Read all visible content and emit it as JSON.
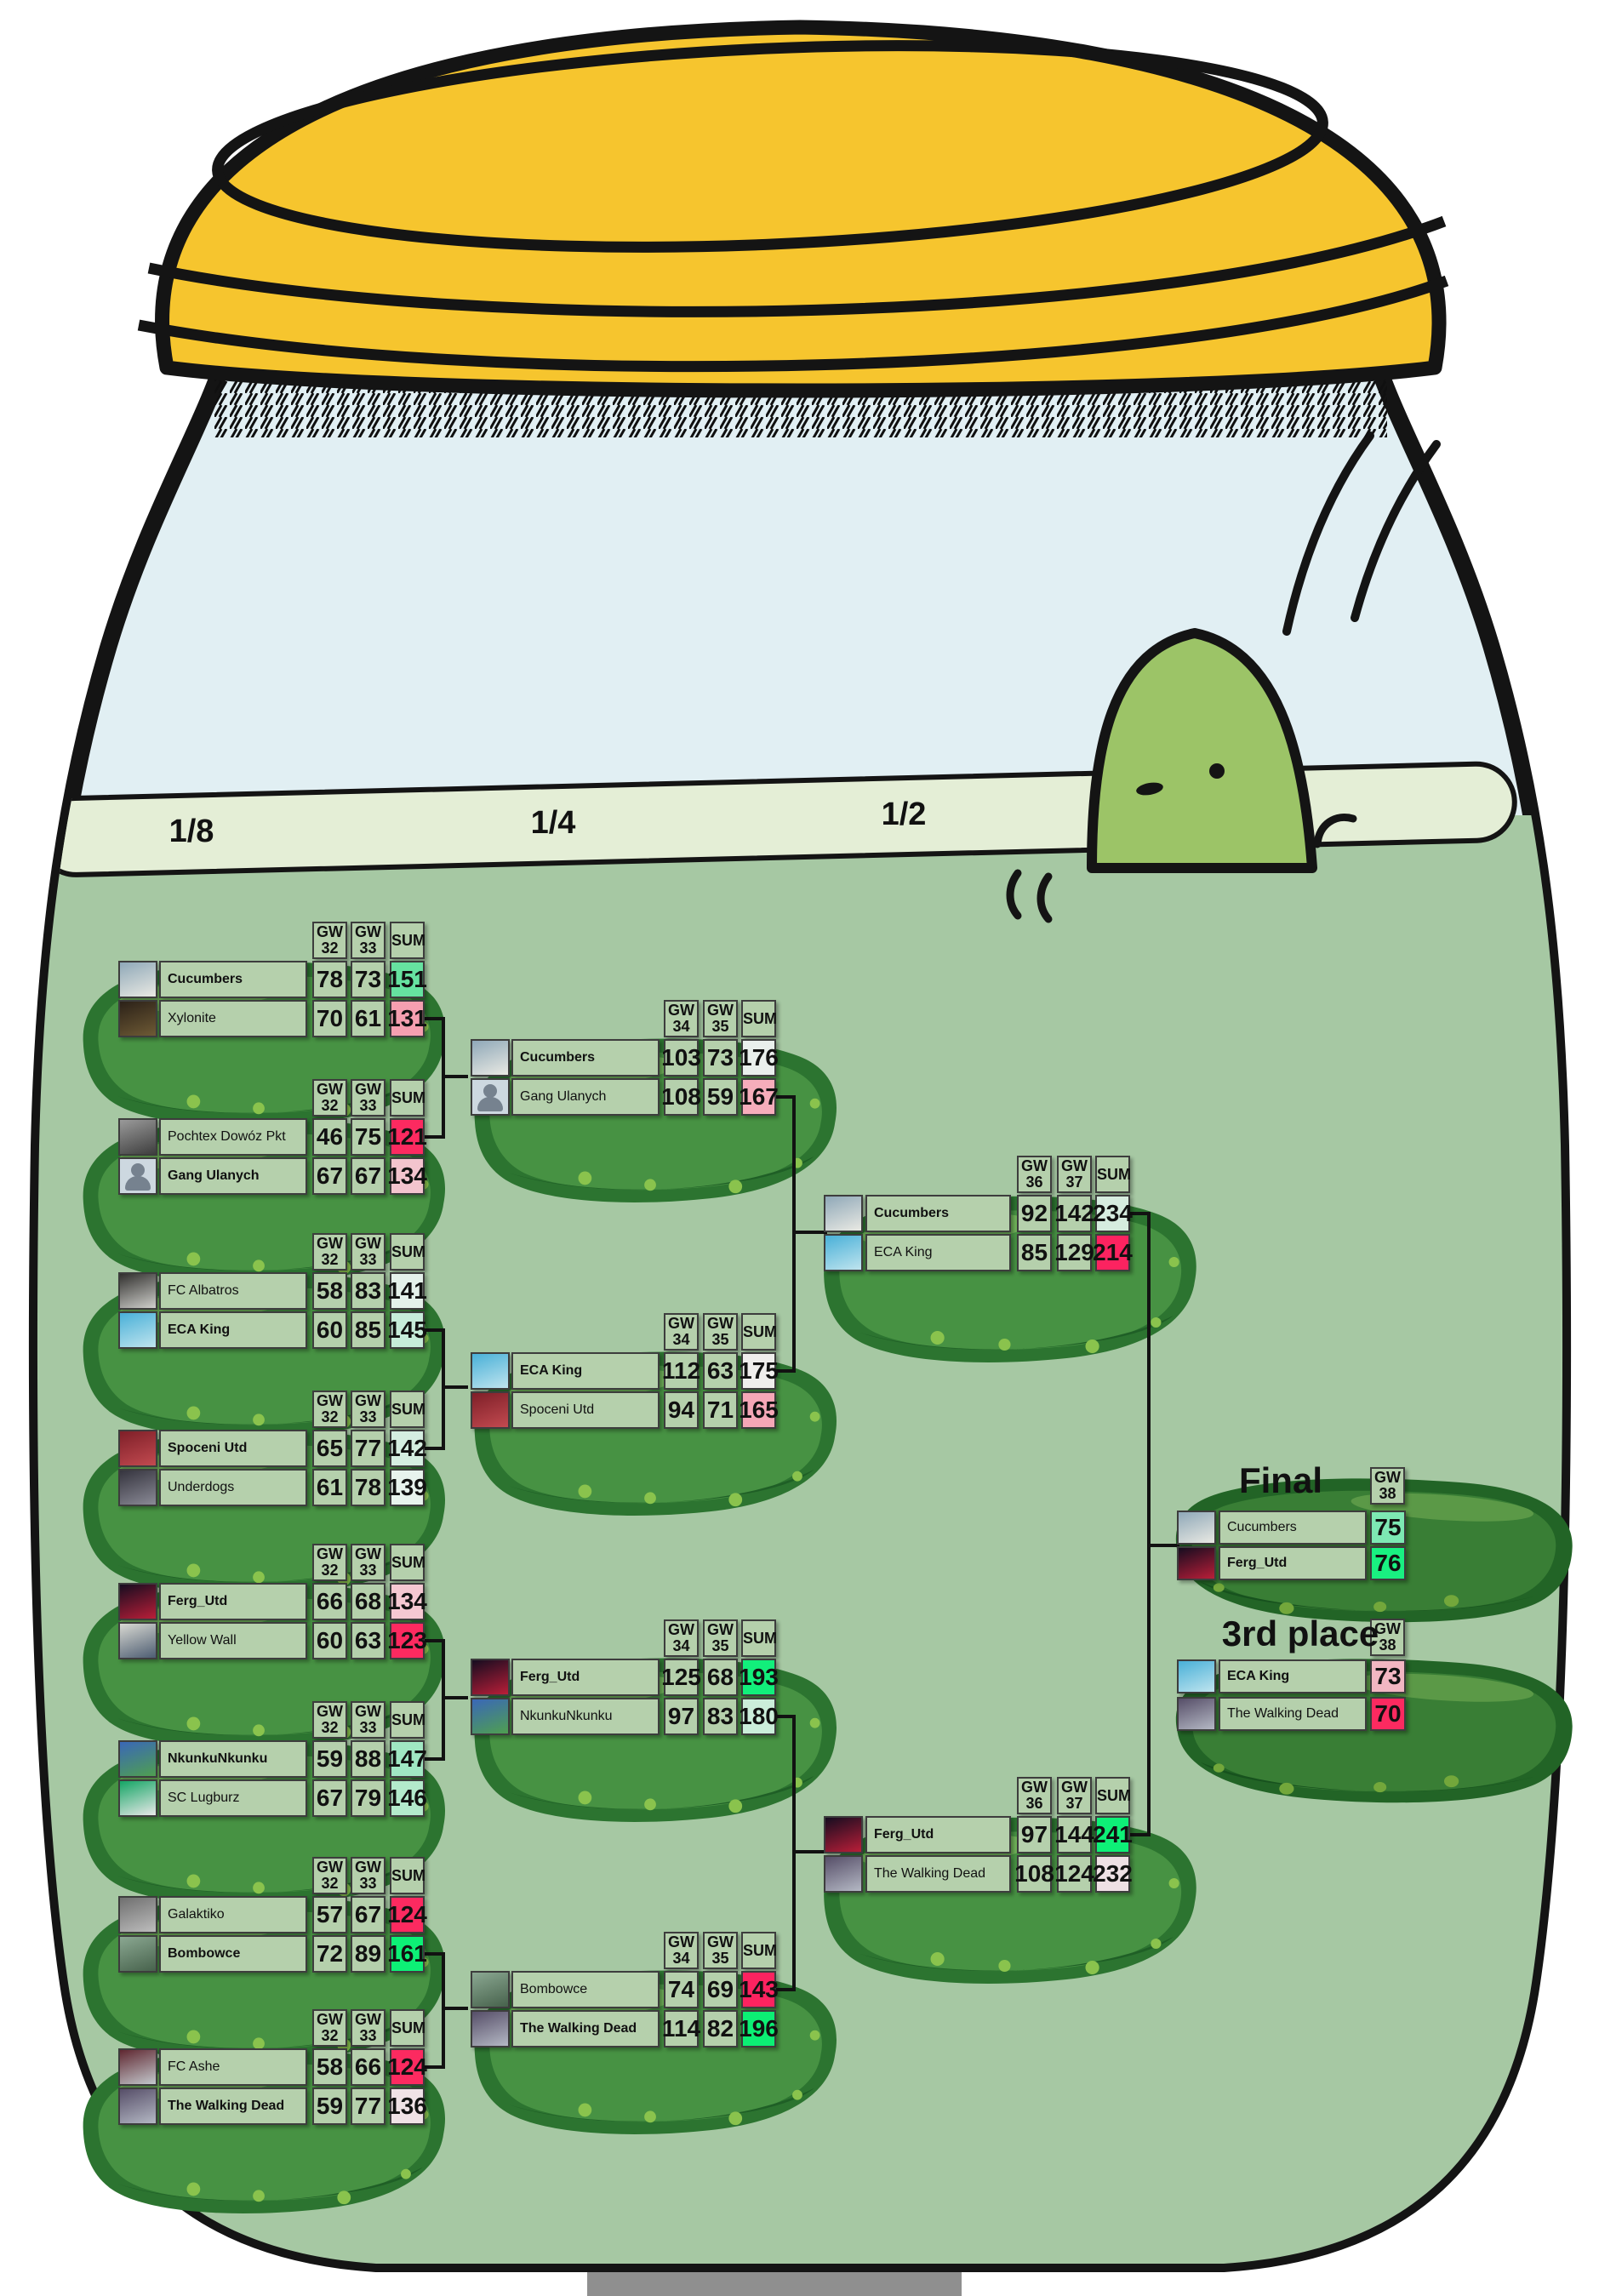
{
  "palette": {
    "water": "#a6c8a3",
    "glass": "#e1eff3",
    "lid": "#f6c52e",
    "cell_bg": "#b5d0ac",
    "connector": "#121212"
  },
  "avatars": {
    "Cucumbers": [
      "#8fa8b8",
      "#e9e9e3"
    ],
    "Xylonite": [
      "#2b2118",
      "#6e5a35"
    ],
    "Pochtex Dowóz Pkt": [
      "#9a9a9a",
      "#3e3e3e"
    ],
    "Gang Ulanych": "placeholder",
    "FC Albatros": [
      "#31302e",
      "#cfcfcb"
    ],
    "ECA King": [
      "#49b0d8",
      "#bfe4ee"
    ],
    "Spoceni Utd": [
      "#7e1f28",
      "#c24a50"
    ],
    "Underdogs": [
      "#35343e",
      "#8a8a96"
    ],
    "Ferg_Utd": [
      "#160d20",
      "#b91e38"
    ],
    "Yellow Wall": [
      "#d9d9d2",
      "#4d5d72"
    ],
    "NkunkuNkunku": [
      "#3a67b8",
      "#4f9f50"
    ],
    "SC Lugburz": [
      "#14a565",
      "#e8e8e8"
    ],
    "Galaktiko": [
      "#6f6f6f",
      "#bdbdbd"
    ],
    "Bombowce": [
      "#8ba892",
      "#47624c"
    ],
    "FC Ashe": [
      "#5f2730",
      "#c3c8cd"
    ],
    "The Walking Dead": [
      "#564e68",
      "#b4b8c4"
    ]
  },
  "rounds": [
    {
      "id": "r18",
      "label": "1/8",
      "col_headers": [
        [
          "GW",
          "32"
        ],
        [
          "GW",
          "33"
        ],
        [
          "SUM"
        ]
      ],
      "matches": [
        {
          "teams": [
            {
              "name": "Cucumbers",
              "winner": true,
              "scores": [
                "78",
                "73"
              ],
              "sum": "151",
              "sum_color": "#66e2a0"
            },
            {
              "name": "Xylonite",
              "winner": false,
              "scores": [
                "70",
                "61"
              ],
              "sum": "131",
              "sum_color": "#f59fb0"
            }
          ]
        },
        {
          "teams": [
            {
              "name": "Pochtex Dowóz Pkt",
              "winner": false,
              "scores": [
                "46",
                "75"
              ],
              "sum": "121",
              "sum_color": "#fc2a60"
            },
            {
              "name": "Gang Ulanych",
              "winner": true,
              "scores": [
                "67",
                "67"
              ],
              "sum": "134",
              "sum_color": "#f3c4ce"
            }
          ]
        },
        {
          "teams": [
            {
              "name": "FC Albatros",
              "winner": false,
              "scores": [
                "58",
                "83"
              ],
              "sum": "141",
              "sum_color": "#e4f1ea"
            },
            {
              "name": "ECA King",
              "winner": true,
              "scores": [
                "60",
                "85"
              ],
              "sum": "145",
              "sum_color": "#c6ecd9"
            }
          ]
        },
        {
          "teams": [
            {
              "name": "Spoceni Utd",
              "winner": true,
              "scores": [
                "65",
                "77"
              ],
              "sum": "142",
              "sum_color": "#d5eee1"
            },
            {
              "name": "Underdogs",
              "winner": false,
              "scores": [
                "61",
                "78"
              ],
              "sum": "139",
              "sum_color": "#e8f3ed"
            }
          ]
        },
        {
          "teams": [
            {
              "name": "Ferg_Utd",
              "winner": true,
              "scores": [
                "66",
                "68"
              ],
              "sum": "134",
              "sum_color": "#f5c8d2"
            },
            {
              "name": "Yellow Wall",
              "winner": false,
              "scores": [
                "60",
                "63"
              ],
              "sum": "123",
              "sum_color": "#fc2a60"
            }
          ]
        },
        {
          "teams": [
            {
              "name": "NkunkuNkunku",
              "winner": true,
              "scores": [
                "59",
                "88"
              ],
              "sum": "147",
              "sum_color": "#a0e7c3"
            },
            {
              "name": "SC Lugburz",
              "winner": false,
              "scores": [
                "67",
                "79"
              ],
              "sum": "146",
              "sum_color": "#b3eacc"
            }
          ]
        },
        {
          "teams": [
            {
              "name": "Galaktiko",
              "winner": false,
              "scores": [
                "57",
                "67"
              ],
              "sum": "124",
              "sum_color": "#fc2a60"
            },
            {
              "name": "Bombowce",
              "winner": true,
              "scores": [
                "72",
                "89"
              ],
              "sum": "161",
              "sum_color": "#0df076"
            }
          ]
        },
        {
          "teams": [
            {
              "name": "FC Ashe",
              "winner": false,
              "scores": [
                "58",
                "66"
              ],
              "sum": "124",
              "sum_color": "#fc2a60"
            },
            {
              "name": "The Walking Dead",
              "winner": true,
              "scores": [
                "59",
                "77"
              ],
              "sum": "136",
              "sum_color": "#f0e2e6"
            }
          ]
        }
      ]
    },
    {
      "id": "r14",
      "label": "1/4",
      "col_headers": [
        [
          "GW",
          "34"
        ],
        [
          "GW",
          "35"
        ],
        [
          "SUM"
        ]
      ],
      "matches": [
        {
          "teams": [
            {
              "name": "Cucumbers",
              "winner": true,
              "scores": [
                "103",
                "73"
              ],
              "sum": "176",
              "sum_color": "#e9efec"
            },
            {
              "name": "Gang Ulanych",
              "winner": false,
              "scores": [
                "108",
                "59"
              ],
              "sum": "167",
              "sum_color": "#f6adbb"
            }
          ]
        },
        {
          "teams": [
            {
              "name": "ECA King",
              "winner": true,
              "scores": [
                "112",
                "63"
              ],
              "sum": "175",
              "sum_color": "#efeeec"
            },
            {
              "name": "Spoceni Utd",
              "winner": false,
              "scores": [
                "94",
                "71"
              ],
              "sum": "165",
              "sum_color": "#f5a7b7"
            }
          ]
        },
        {
          "teams": [
            {
              "name": "Ferg_Utd",
              "winner": true,
              "scores": [
                "125",
                "68"
              ],
              "sum": "193",
              "sum_color": "#12ef7b"
            },
            {
              "name": "NkunkuNkunku",
              "winner": false,
              "scores": [
                "97",
                "83"
              ],
              "sum": "180",
              "sum_color": "#cbeeda"
            }
          ]
        },
        {
          "teams": [
            {
              "name": "Bombowce",
              "winner": false,
              "scores": [
                "74",
                "69"
              ],
              "sum": "143",
              "sum_color": "#fc2360"
            },
            {
              "name": "The Walking Dead",
              "winner": true,
              "scores": [
                "114",
                "82"
              ],
              "sum": "196",
              "sum_color": "#0cef74"
            }
          ]
        }
      ]
    },
    {
      "id": "r12",
      "label": "1/2",
      "col_headers": [
        [
          "GW",
          "36"
        ],
        [
          "GW",
          "37"
        ],
        [
          "SUM"
        ]
      ],
      "matches": [
        {
          "teams": [
            {
              "name": "Cucumbers",
              "winner": true,
              "scores": [
                "92",
                "142"
              ],
              "sum": "234",
              "sum_color": "#d6ecdf"
            },
            {
              "name": "ECA King",
              "winner": false,
              "scores": [
                "85",
                "129"
              ],
              "sum": "214",
              "sum_color": "#fc2360"
            }
          ]
        },
        {
          "teams": [
            {
              "name": "Ferg_Utd",
              "winner": true,
              "scores": [
                "97",
                "144"
              ],
              "sum": "241",
              "sum_color": "#0ef077"
            },
            {
              "name": "The Walking Dead",
              "winner": false,
              "scores": [
                "108",
                "124"
              ],
              "sum": "232",
              "sum_color": "#eee0e4"
            }
          ]
        }
      ]
    },
    {
      "id": "final",
      "title": "Final",
      "col_headers": [
        [
          "GW",
          "38"
        ]
      ],
      "matches": [
        {
          "teams": [
            {
              "name": "Cucumbers",
              "winner": false,
              "scores": [],
              "sum": "75",
              "sum_color": "#7de8b3"
            },
            {
              "name": "Ferg_Utd",
              "winner": true,
              "scores": [],
              "sum": "76",
              "sum_color": "#19f081"
            }
          ]
        }
      ]
    },
    {
      "id": "third",
      "title": "3rd place",
      "col_headers": [
        [
          "GW",
          "38"
        ]
      ],
      "matches": [
        {
          "teams": [
            {
              "name": "ECA King",
              "winner": true,
              "scores": [],
              "sum": "73",
              "sum_color": "#f2b6c2"
            },
            {
              "name": "The Walking Dead",
              "winner": false,
              "scores": [],
              "sum": "70",
              "sum_color": "#fc2a60"
            }
          ]
        }
      ]
    }
  ]
}
